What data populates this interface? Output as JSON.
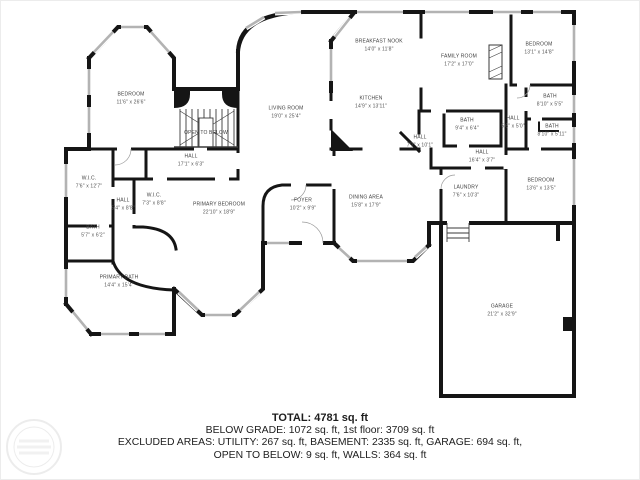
{
  "plan": {
    "rooms": [
      {
        "name": "BEDROOM",
        "dims": "11'6\" x 26'6\"",
        "x": 130,
        "y": 98
      },
      {
        "name": "OPEN TO BELOW",
        "dims": "",
        "x": 205,
        "y": 133
      },
      {
        "name": "LIVING ROOM",
        "dims": "19'0\" x 25'4\"",
        "x": 285,
        "y": 112
      },
      {
        "name": "BREAKFAST NOOK",
        "dims": "14'0\" x 11'8\"",
        "x": 378,
        "y": 45
      },
      {
        "name": "FAMILY ROOM",
        "dims": "17'2\" x 17'0\"",
        "x": 458,
        "y": 60
      },
      {
        "name": "BEDROOM",
        "dims": "13'1\" x 14'8\"",
        "x": 538,
        "y": 48
      },
      {
        "name": "KITCHEN",
        "dims": "14'9\" x 13'11\"",
        "x": 370,
        "y": 102
      },
      {
        "name": "BATH",
        "dims": "8'10\" x 5'5\"",
        "x": 549,
        "y": 100
      },
      {
        "name": "HALL",
        "dims": "5'6\" x 5'0\"",
        "x": 512,
        "y": 122
      },
      {
        "name": "BATH",
        "dims": "8'10\" x 5'11\"",
        "x": 551,
        "y": 130
      },
      {
        "name": "BATH",
        "dims": "9'4\" x 6'4\"",
        "x": 466,
        "y": 124
      },
      {
        "name": "HALL",
        "dims": "7'7\" x 10'1\"",
        "x": 419,
        "y": 141
      },
      {
        "name": "HALL",
        "dims": "16'4\" x 3'7\"",
        "x": 481,
        "y": 156
      },
      {
        "name": "HALL",
        "dims": "17'1\" x 6'3\"",
        "x": 190,
        "y": 160
      },
      {
        "name": "W.I.C.",
        "dims": "7'6\" x 12'7\"",
        "x": 88,
        "y": 182
      },
      {
        "name": "HALL",
        "dims": "5'4\" x 8'8\"",
        "x": 122,
        "y": 204
      },
      {
        "name": "W.I.C.",
        "dims": "7'3\" x 8'8\"",
        "x": 153,
        "y": 199
      },
      {
        "name": "BATH",
        "dims": "5'7\" x 6'2\"",
        "x": 92,
        "y": 231
      },
      {
        "name": "FOYER",
        "dims": "10'2\" x 9'9\"",
        "x": 302,
        "y": 204
      },
      {
        "name": "PRIMARY BEDROOM",
        "dims": "22'10\" x 18'9\"",
        "x": 218,
        "y": 208
      },
      {
        "name": "DINING AREA",
        "dims": "15'8\" x 17'9\"",
        "x": 365,
        "y": 201
      },
      {
        "name": "LAUNDRY",
        "dims": "7'6\" x 10'3\"",
        "x": 465,
        "y": 191
      },
      {
        "name": "BEDROOM",
        "dims": "13'6\" x 13'5\"",
        "x": 540,
        "y": 184
      },
      {
        "name": "PRIMARY BATH",
        "dims": "14'4\" x 15'4\"",
        "x": 118,
        "y": 281
      },
      {
        "name": "GARAGE",
        "dims": "21'2\" x 32'9\"",
        "x": 501,
        "y": 310
      }
    ]
  },
  "summary": {
    "line1": "TOTAL: 4781 sq. ft",
    "line2": "BELOW GRADE: 1072 sq. ft, 1st floor: 3709 sq. ft",
    "line3": "EXCLUDED AREAS: UTILITY: 267 sq. ft, BASEMENT: 2335 sq. ft, GARAGE: 694 sq. ft,",
    "line4": "OPEN TO BELOW: 9 sq. ft, WALLS: 364 sq. ft"
  }
}
